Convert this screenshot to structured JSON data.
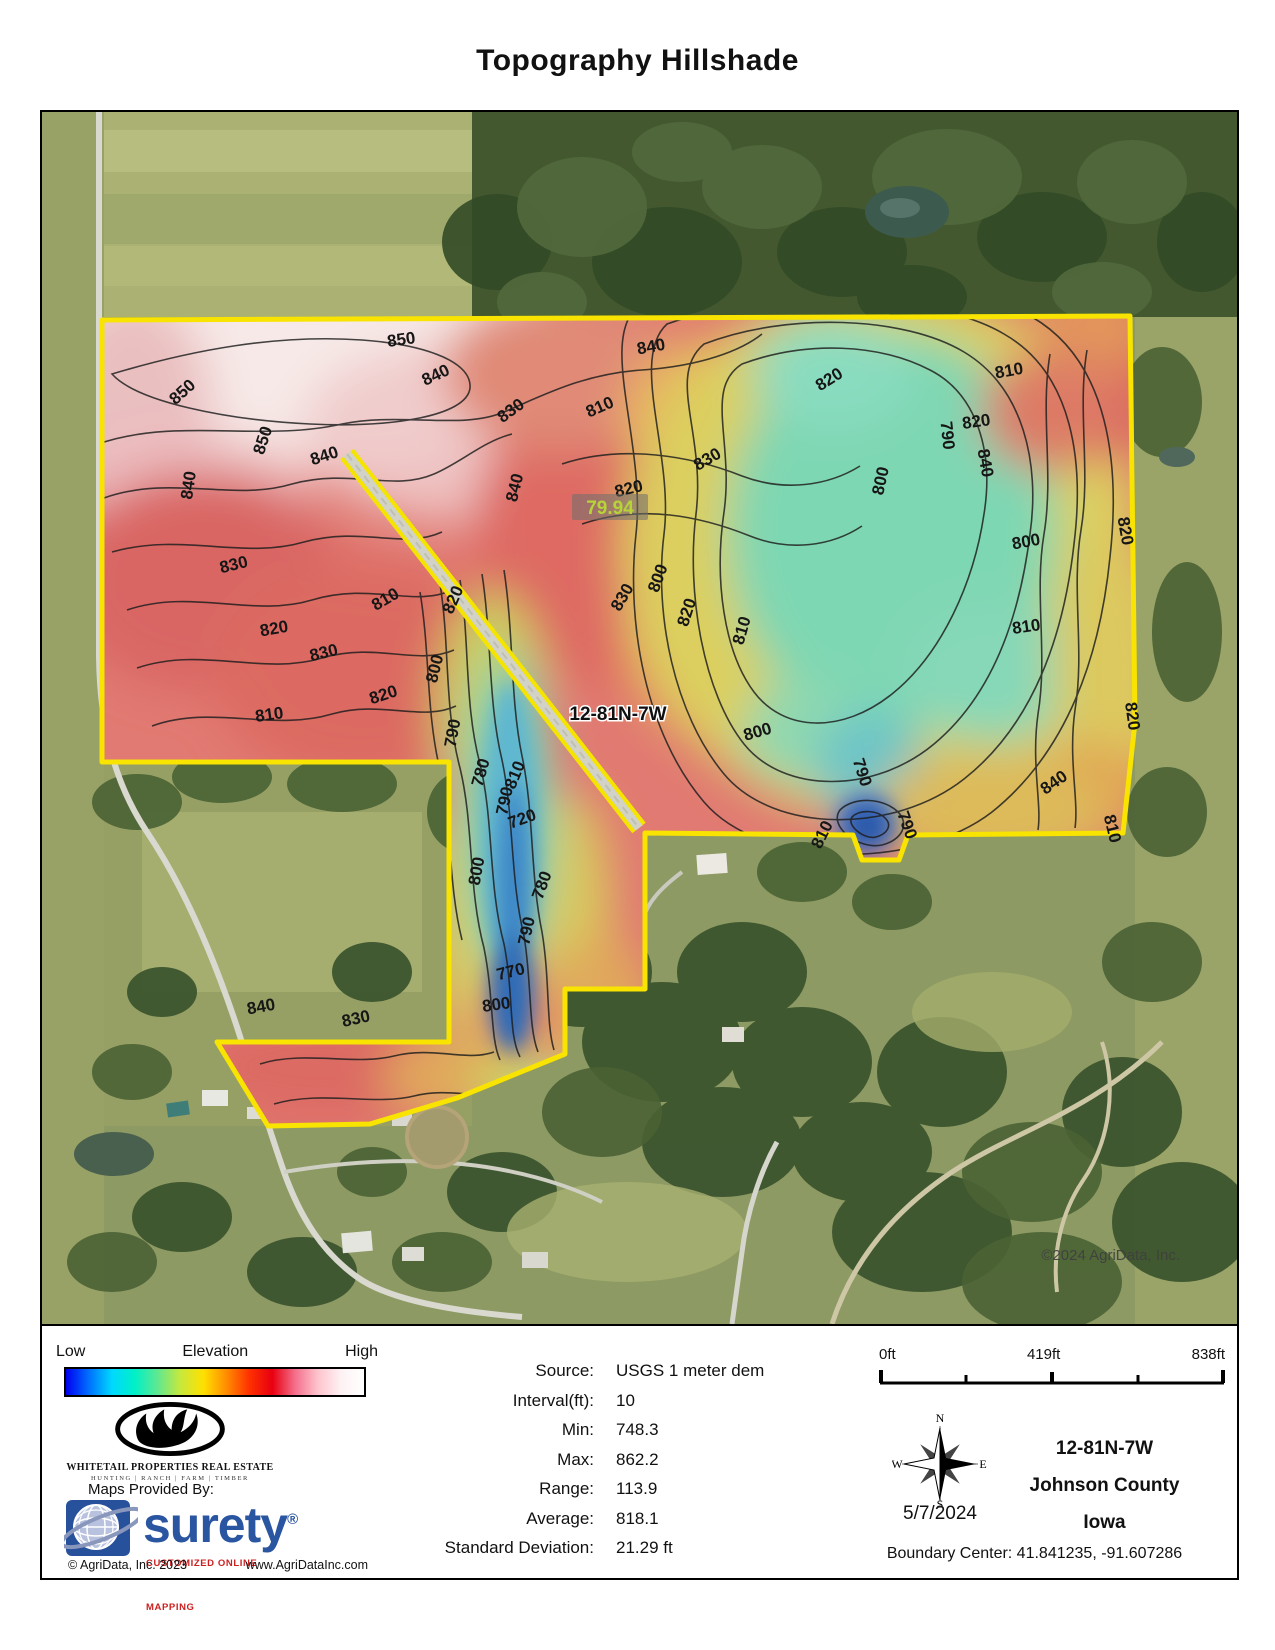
{
  "title": "Topography Hillshade",
  "map": {
    "section_label": "12-81N-7W",
    "acres_label": "79.94",
    "watermark": "©2024 AgriData, Inc.",
    "contour_labels": [
      {
        "t": "850",
        "x": 360,
        "y": 233,
        "r": -8
      },
      {
        "t": "840",
        "x": 396,
        "y": 268,
        "r": -25
      },
      {
        "t": "850",
        "x": 144,
        "y": 284,
        "r": -42
      },
      {
        "t": "850",
        "x": 226,
        "y": 330,
        "r": -72
      },
      {
        "t": "840",
        "x": 284,
        "y": 349,
        "r": -18
      },
      {
        "t": "840",
        "x": 152,
        "y": 374,
        "r": -82
      },
      {
        "t": "840",
        "x": 478,
        "y": 377,
        "r": -76
      },
      {
        "t": "830",
        "x": 472,
        "y": 303,
        "r": -36
      },
      {
        "t": "810",
        "x": 560,
        "y": 300,
        "r": -24
      },
      {
        "t": "840",
        "x": 610,
        "y": 240,
        "r": -10
      },
      {
        "t": "830",
        "x": 668,
        "y": 352,
        "r": -30
      },
      {
        "t": "820",
        "x": 790,
        "y": 272,
        "r": -32
      },
      {
        "t": "800",
        "x": 844,
        "y": 370,
        "r": -78
      },
      {
        "t": "810",
        "x": 968,
        "y": 264,
        "r": -10
      },
      {
        "t": "790",
        "x": 900,
        "y": 324,
        "r": 84
      },
      {
        "t": "840",
        "x": 938,
        "y": 352,
        "r": 80
      },
      {
        "t": "820",
        "x": 935,
        "y": 315,
        "r": -8
      },
      {
        "t": "800",
        "x": 985,
        "y": 435,
        "r": -10
      },
      {
        "t": "820",
        "x": 1078,
        "y": 420,
        "r": 80
      },
      {
        "t": "810",
        "x": 985,
        "y": 520,
        "r": -8
      },
      {
        "t": "820",
        "x": 1085,
        "y": 605,
        "r": 82
      },
      {
        "t": "840",
        "x": 1015,
        "y": 675,
        "r": -35
      },
      {
        "t": "810",
        "x": 1065,
        "y": 718,
        "r": 76
      },
      {
        "t": "820",
        "x": 588,
        "y": 382,
        "r": -14
      },
      {
        "t": "830",
        "x": 585,
        "y": 488,
        "r": -60
      },
      {
        "t": "800",
        "x": 621,
        "y": 468,
        "r": -70
      },
      {
        "t": "820",
        "x": 650,
        "y": 502,
        "r": -72
      },
      {
        "t": "810",
        "x": 705,
        "y": 520,
        "r": -74
      },
      {
        "t": "800",
        "x": 717,
        "y": 625,
        "r": -16
      },
      {
        "t": "790",
        "x": 815,
        "y": 662,
        "r": 72
      },
      {
        "t": "810",
        "x": 785,
        "y": 725,
        "r": -64
      },
      {
        "t": "790",
        "x": 860,
        "y": 715,
        "r": 70
      },
      {
        "t": "830",
        "x": 193,
        "y": 458,
        "r": -14
      },
      {
        "t": "820",
        "x": 233,
        "y": 522,
        "r": -10
      },
      {
        "t": "830",
        "x": 283,
        "y": 546,
        "r": -14
      },
      {
        "t": "810",
        "x": 228,
        "y": 608,
        "r": -8
      },
      {
        "t": "820",
        "x": 343,
        "y": 588,
        "r": -18
      },
      {
        "t": "810",
        "x": 346,
        "y": 492,
        "r": -30
      },
      {
        "t": "820",
        "x": 416,
        "y": 490,
        "r": -66
      },
      {
        "t": "800",
        "x": 398,
        "y": 558,
        "r": -76
      },
      {
        "t": "790",
        "x": 416,
        "y": 622,
        "r": -80
      },
      {
        "t": "780",
        "x": 444,
        "y": 662,
        "r": -74
      },
      {
        "t": "810",
        "x": 478,
        "y": 665,
        "r": -68
      },
      {
        "t": "790",
        "x": 468,
        "y": 690,
        "r": -78
      },
      {
        "t": "720",
        "x": 482,
        "y": 712,
        "r": -20
      },
      {
        "t": "800",
        "x": 440,
        "y": 760,
        "r": -80
      },
      {
        "t": "780",
        "x": 505,
        "y": 775,
        "r": -70
      },
      {
        "t": "790",
        "x": 490,
        "y": 820,
        "r": -78
      },
      {
        "t": "770",
        "x": 470,
        "y": 865,
        "r": -14
      },
      {
        "t": "800",
        "x": 455,
        "y": 898,
        "r": -8
      },
      {
        "t": "840",
        "x": 220,
        "y": 900,
        "r": -10
      },
      {
        "t": "830",
        "x": 315,
        "y": 912,
        "r": -12
      }
    ]
  },
  "legend": {
    "low": "Low",
    "elevation": "Elevation",
    "high": "High",
    "gradient_stops": [
      "#0000F0",
      "#0070FF",
      "#00D8FF",
      "#00F0C8",
      "#60E890",
      "#C8E83C",
      "#FFE000",
      "#FF8C00",
      "#FF3000",
      "#E80010",
      "#F4708C",
      "#FFC4CE",
      "#FDF2F4",
      "#FFFFFF"
    ],
    "whitetail_name": "WHITETAIL PROPERTIES REAL ESTATE",
    "whitetail_tagline": "HUNTING | RANCH | FARM | TIMBER",
    "maps_provided_by": "Maps Provided By:",
    "surety_name": "surety",
    "surety_reg": "®",
    "surety_tagline": "CUSTOMIZED ONLINE MAPPING",
    "copyright": "© AgriData, Inc. 2023",
    "website": "www.AgriDataInc.com"
  },
  "stats": {
    "rows": [
      {
        "label": "Source:",
        "value": "USGS 1 meter dem"
      },
      {
        "label": "Interval(ft):",
        "value": "10"
      },
      {
        "label": "Min:",
        "value": "748.3"
      },
      {
        "label": "Max:",
        "value": "862.2"
      },
      {
        "label": "Range:",
        "value": "113.9"
      },
      {
        "label": "Average:",
        "value": "818.1"
      },
      {
        "label": "Standard Deviation:",
        "value": "21.29 ft"
      }
    ]
  },
  "scalebar": {
    "start": "0ft",
    "mid": "419ft",
    "end": "838ft"
  },
  "compass": {
    "n": "N",
    "e": "E",
    "s": "S",
    "w": "W",
    "date": "5/7/2024"
  },
  "location": {
    "township": "12-81N-7W",
    "county": "Johnson County",
    "state": "Iowa",
    "boundary_center": "Boundary Center: 41.841235, -91.607286"
  },
  "colors": {
    "boundary_yellow": "#F8E400",
    "contour_line": "#1D1D1D",
    "surety_blue": "#2A55A0",
    "surety_red": "#CC1F1F",
    "acres_label_green": "#B6D438"
  }
}
